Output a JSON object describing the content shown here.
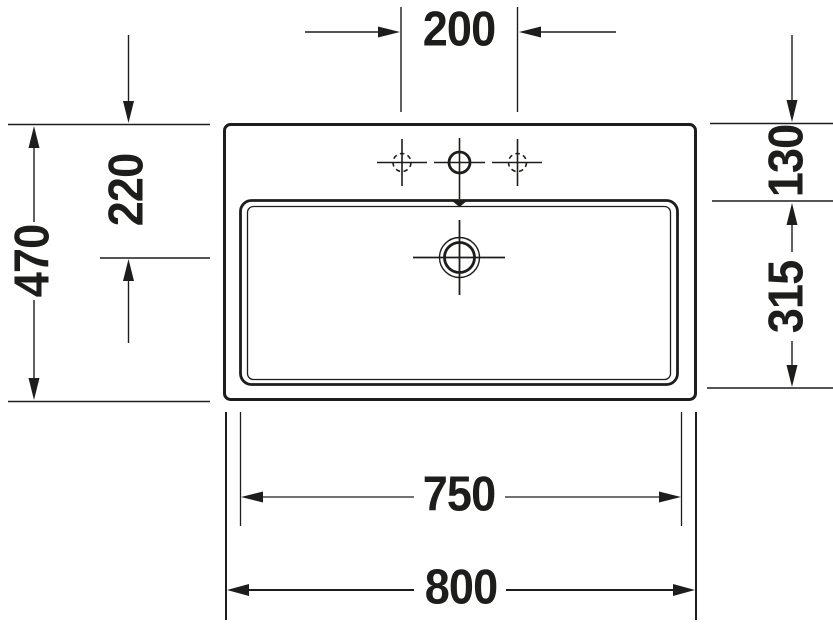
{
  "drawing": {
    "name": "washbasin-technical-top-view",
    "dimensions": {
      "faucet_hole_spacing": {
        "label": "200"
      },
      "overall_depth": {
        "label": "470"
      },
      "front_edge_to_drain": {
        "label": "220"
      },
      "back_rim_to_bowl": {
        "label": "130"
      },
      "bowl_depth": {
        "label": "315"
      },
      "bowl_width": {
        "label": "750"
      },
      "overall_width": {
        "label": "800"
      }
    },
    "colors": {
      "line": "#1d1d1b",
      "background": "#ffffff"
    }
  }
}
